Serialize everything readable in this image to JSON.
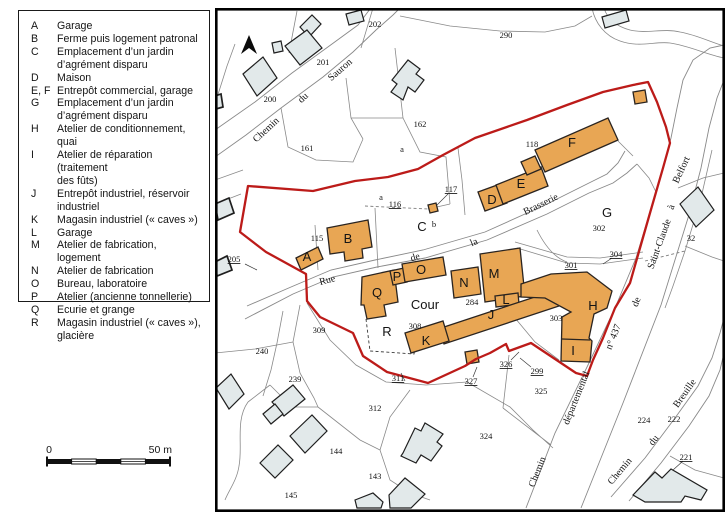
{
  "legend": {
    "entries": [
      {
        "key": "A",
        "label": "Garage"
      },
      {
        "key": "B",
        "label": "Ferme puis logement patronal"
      },
      {
        "key": "C",
        "label": "Emplacement d’un jardin\nd’agrément disparu"
      },
      {
        "key": "D",
        "label": "Maison"
      },
      {
        "key": "E, F",
        "label": "Entrepôt commercial, garage"
      },
      {
        "key": "G",
        "label": "Emplacement d’un jardin\nd’agrément disparu"
      },
      {
        "key": "H",
        "label": "Atelier de conditionnement, quai"
      },
      {
        "key": "I",
        "label": "Atelier de réparation (traitement\ndes fûts)"
      },
      {
        "key": "J",
        "label": "Entrepôt industriel, réservoir\nindustriel"
      },
      {
        "key": "K",
        "label": "Magasin industriel (« caves »)"
      },
      {
        "key": "L",
        "label": "Garage"
      },
      {
        "key": "M",
        "label": "Atelier de fabrication, logement"
      },
      {
        "key": "N",
        "label": "Atelier de fabrication"
      },
      {
        "key": "O",
        "label": "Bureau, laboratoire"
      },
      {
        "key": "P",
        "label": "Atelier (ancienne tonnellerie)"
      },
      {
        "key": "Q",
        "label": "Ecurie et grange"
      },
      {
        "key": "R",
        "label": "Magasin industriel (« caves »),\nglacière"
      }
    ]
  },
  "scale_bar": {
    "zero": "0",
    "max": "50 m"
  },
  "map": {
    "streets": {
      "sauron": [
        "Chemin",
        "du",
        "Sauron"
      ],
      "brasserie": [
        "Rue",
        "de",
        "la",
        "Brasserie"
      ],
      "departementale": [
        "Chemin",
        "départemental",
        "n° 437",
        "de",
        "Saint-Claude",
        "à",
        "Belfort"
      ],
      "breuille": [
        "Chemin",
        "du",
        "Breuille"
      ]
    },
    "buildings": {
      "A": "A",
      "B": "B",
      "D": "D",
      "E": "E",
      "F": "F",
      "H": "H",
      "I": "I",
      "J": "J",
      "K": "K",
      "L": "L",
      "M": "M",
      "N": "N",
      "O": "O",
      "P": "P",
      "Q": "Q",
      "R": "R"
    },
    "areas": {
      "C": "C",
      "G": "G",
      "cour": "Cour"
    },
    "parcels": {
      "n202": "202",
      "n290": "290",
      "n201": "201",
      "n200": "200",
      "n162": "162",
      "n161": "161",
      "n118": "118",
      "n117": "117",
      "n116": "116",
      "n115": "115",
      "n302": "302",
      "n32": "32",
      "n205": "205",
      "n304": "304",
      "n301": "301",
      "n284": "284",
      "n303": "303",
      "n309": "309",
      "n308": "308",
      "n240": "240",
      "n239": "239",
      "n311": "311",
      "n326": "326",
      "n299": "299",
      "n327": "327",
      "n325": "325",
      "n312": "312",
      "n324": "324",
      "n144": "144",
      "n143": "143",
      "n145": "145",
      "n224": "224",
      "n222": "222",
      "n221": "221",
      "a1": "a",
      "a2": "a",
      "b": "b"
    },
    "colors": {
      "site_boundary": "#bc1b19",
      "inventory_building_fill": "#e8a654",
      "building_stroke": "#2a2420",
      "other_building_fill": "#e2e9ea",
      "parcel_line": "#898989",
      "text": "#141414"
    }
  }
}
